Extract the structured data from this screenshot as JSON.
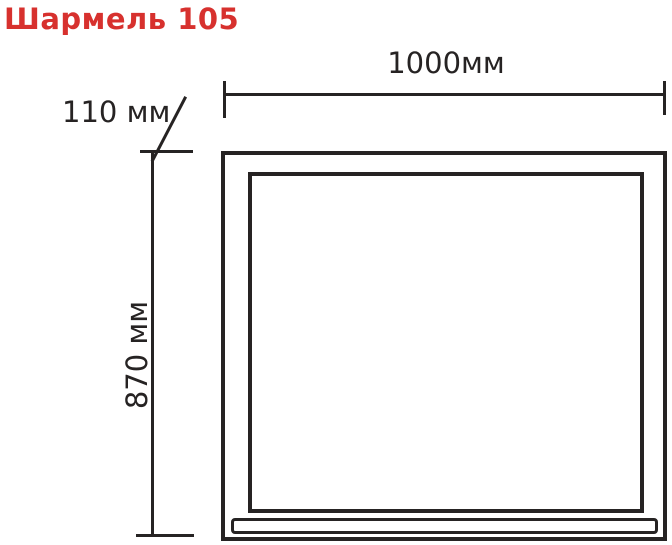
{
  "title": {
    "text": "Шармель 105",
    "color": "#d7312e"
  },
  "drawing": {
    "type": "furniture-dimension-diagram",
    "line_color": "#262323",
    "background_color": "#ffffff",
    "dimensions": {
      "width": {
        "label": "1000мм",
        "value_mm": 1000
      },
      "height": {
        "label": "870 мм",
        "value_mm": 870
      },
      "depth": {
        "label": "110 мм",
        "value_mm": 110
      }
    }
  }
}
